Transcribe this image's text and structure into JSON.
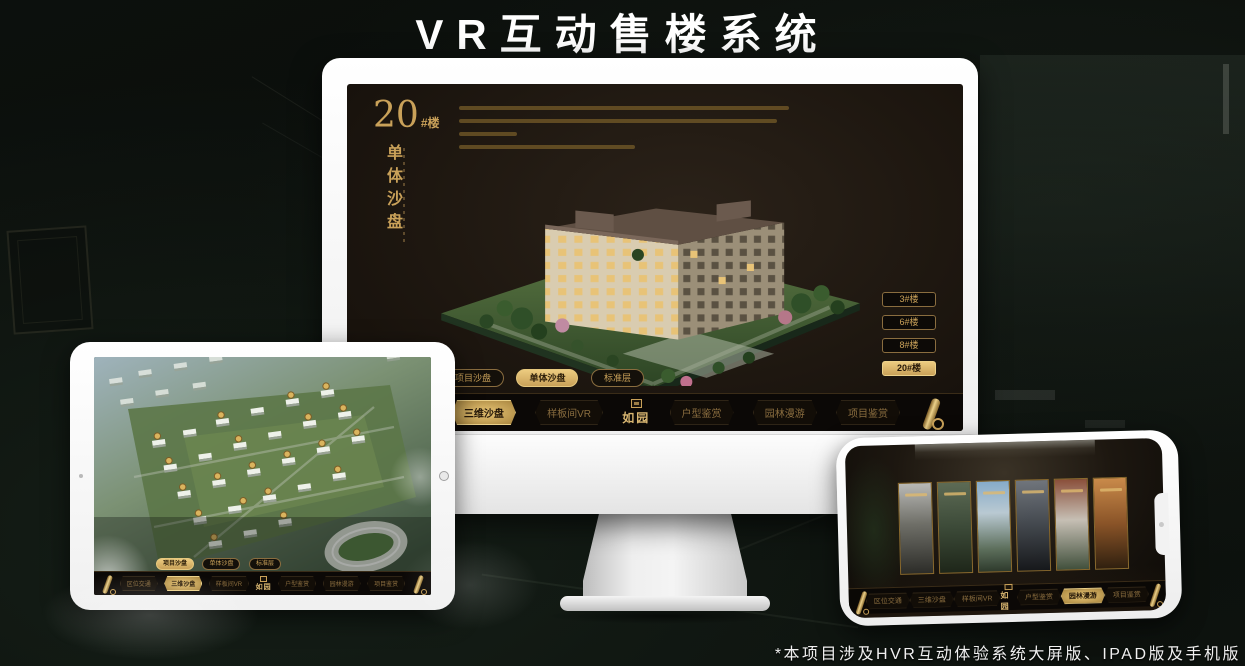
{
  "poster": {
    "title": "VR互动售楼系统",
    "footnote": "*本项目涉及HVR互动体验系统大屏版、IPAD版及手机版"
  },
  "screen20": {
    "number": "20",
    "number_suffix": "#楼",
    "vertical_title": "单体沙盘",
    "floor_buttons": [
      {
        "label": "3#楼"
      },
      {
        "label": "6#楼"
      },
      {
        "label": "8#楼"
      },
      {
        "label": "20#楼"
      }
    ],
    "selected_floor": "20#楼"
  },
  "subtabs": [
    {
      "label": "项目沙盘"
    },
    {
      "label": "单体沙盘"
    },
    {
      "label": "标准层"
    }
  ],
  "nav": {
    "logo": "如园",
    "items": [
      {
        "label": "区位交通"
      },
      {
        "label": "三维沙盘"
      },
      {
        "label": "样板间VR"
      },
      {
        "label": "户型鉴赏"
      },
      {
        "label": "园林漫游"
      },
      {
        "label": "项目鉴赏"
      }
    ]
  },
  "colors": {
    "gold": "#c9a159",
    "gold_bright": "#eccb7f",
    "screen_brown": "#1e1710",
    "navbar_black": "#0b0806",
    "poster_black": "#0a0d0a",
    "title_white": "#ffffff"
  },
  "icons": {
    "scroll_menu": "scroll-icon",
    "logo_seal": "seal-icon"
  }
}
